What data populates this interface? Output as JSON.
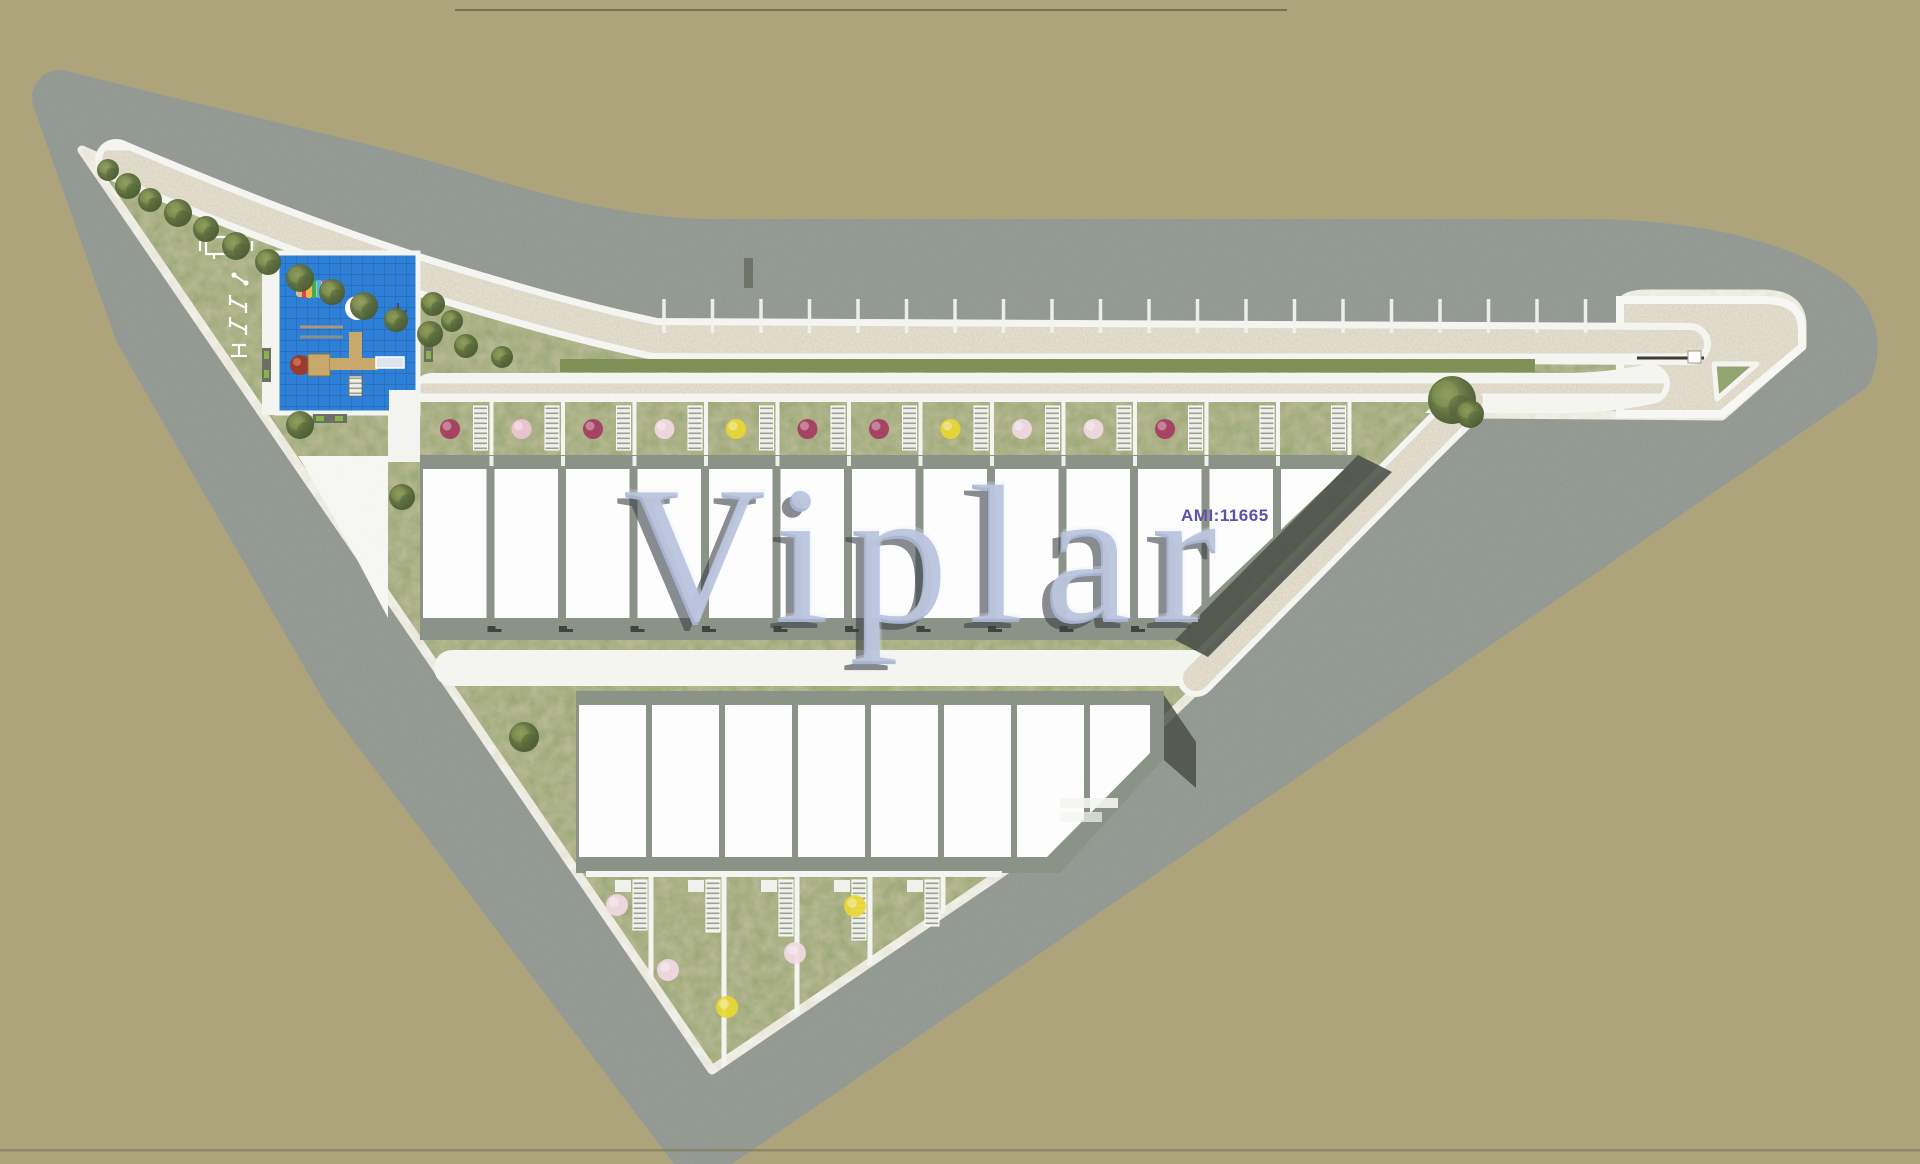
{
  "watermark": {
    "text": "Viplar"
  },
  "ami_label": {
    "text": "AMI:11665"
  },
  "palette": {
    "bg": "#ada47b",
    "street": "#90968f",
    "street_noise": "#565c55",
    "path_beige": "#d5cdb7",
    "white_line": "#f4f5f1",
    "plaza_white": "#f3f4ef",
    "grass": "#94a471",
    "grass_dark": "#7f9156",
    "roof_white": "#fcfdfc",
    "roof_band": "#8b9288",
    "shadow_dark": "#454b44",
    "play_blue": "#2e7fd6",
    "play_grid": "#2465b4",
    "tree_dark": "#4f6238",
    "tree_mid": "#66793f",
    "tree_light": "#8b9a57",
    "flower_magenta": "#a63a60",
    "flower_pink": "#eec4d6",
    "flower_blossom": "#f2d9e4",
    "flower_yellow": "#e8d832",
    "wood": "#c9a96b",
    "dome_red": "#9c3a2b",
    "slide_gray": "#dce5ea",
    "bench_green": "#86b34a",
    "bench_frame": "#6b6f66",
    "gate_line": "#3c3c30",
    "viplar_fill": "#a9b6d4",
    "viplar_shadow": "#3c4048",
    "viplar_highlight": "#e9eef7",
    "ami_color": "#5b53a8",
    "boundary_line": "#6b6a52"
  },
  "site": {
    "row1_units": 13,
    "row2_units": 8,
    "parking_stalls": 20,
    "row1_flower_colors": [
      "magenta",
      "pink",
      "magenta",
      "blossom",
      "yellow",
      "magenta",
      "magenta",
      "yellow",
      "blossom",
      "blossom",
      "magenta"
    ],
    "row2_flower_colors": [
      "blossom",
      "blossom",
      "yellow",
      "blossom",
      "yellow"
    ],
    "row2_garden_fences": 5,
    "amenities": [
      "playground",
      "outdoor-gym",
      "benches",
      "private-gardens",
      "street-parking"
    ]
  }
}
